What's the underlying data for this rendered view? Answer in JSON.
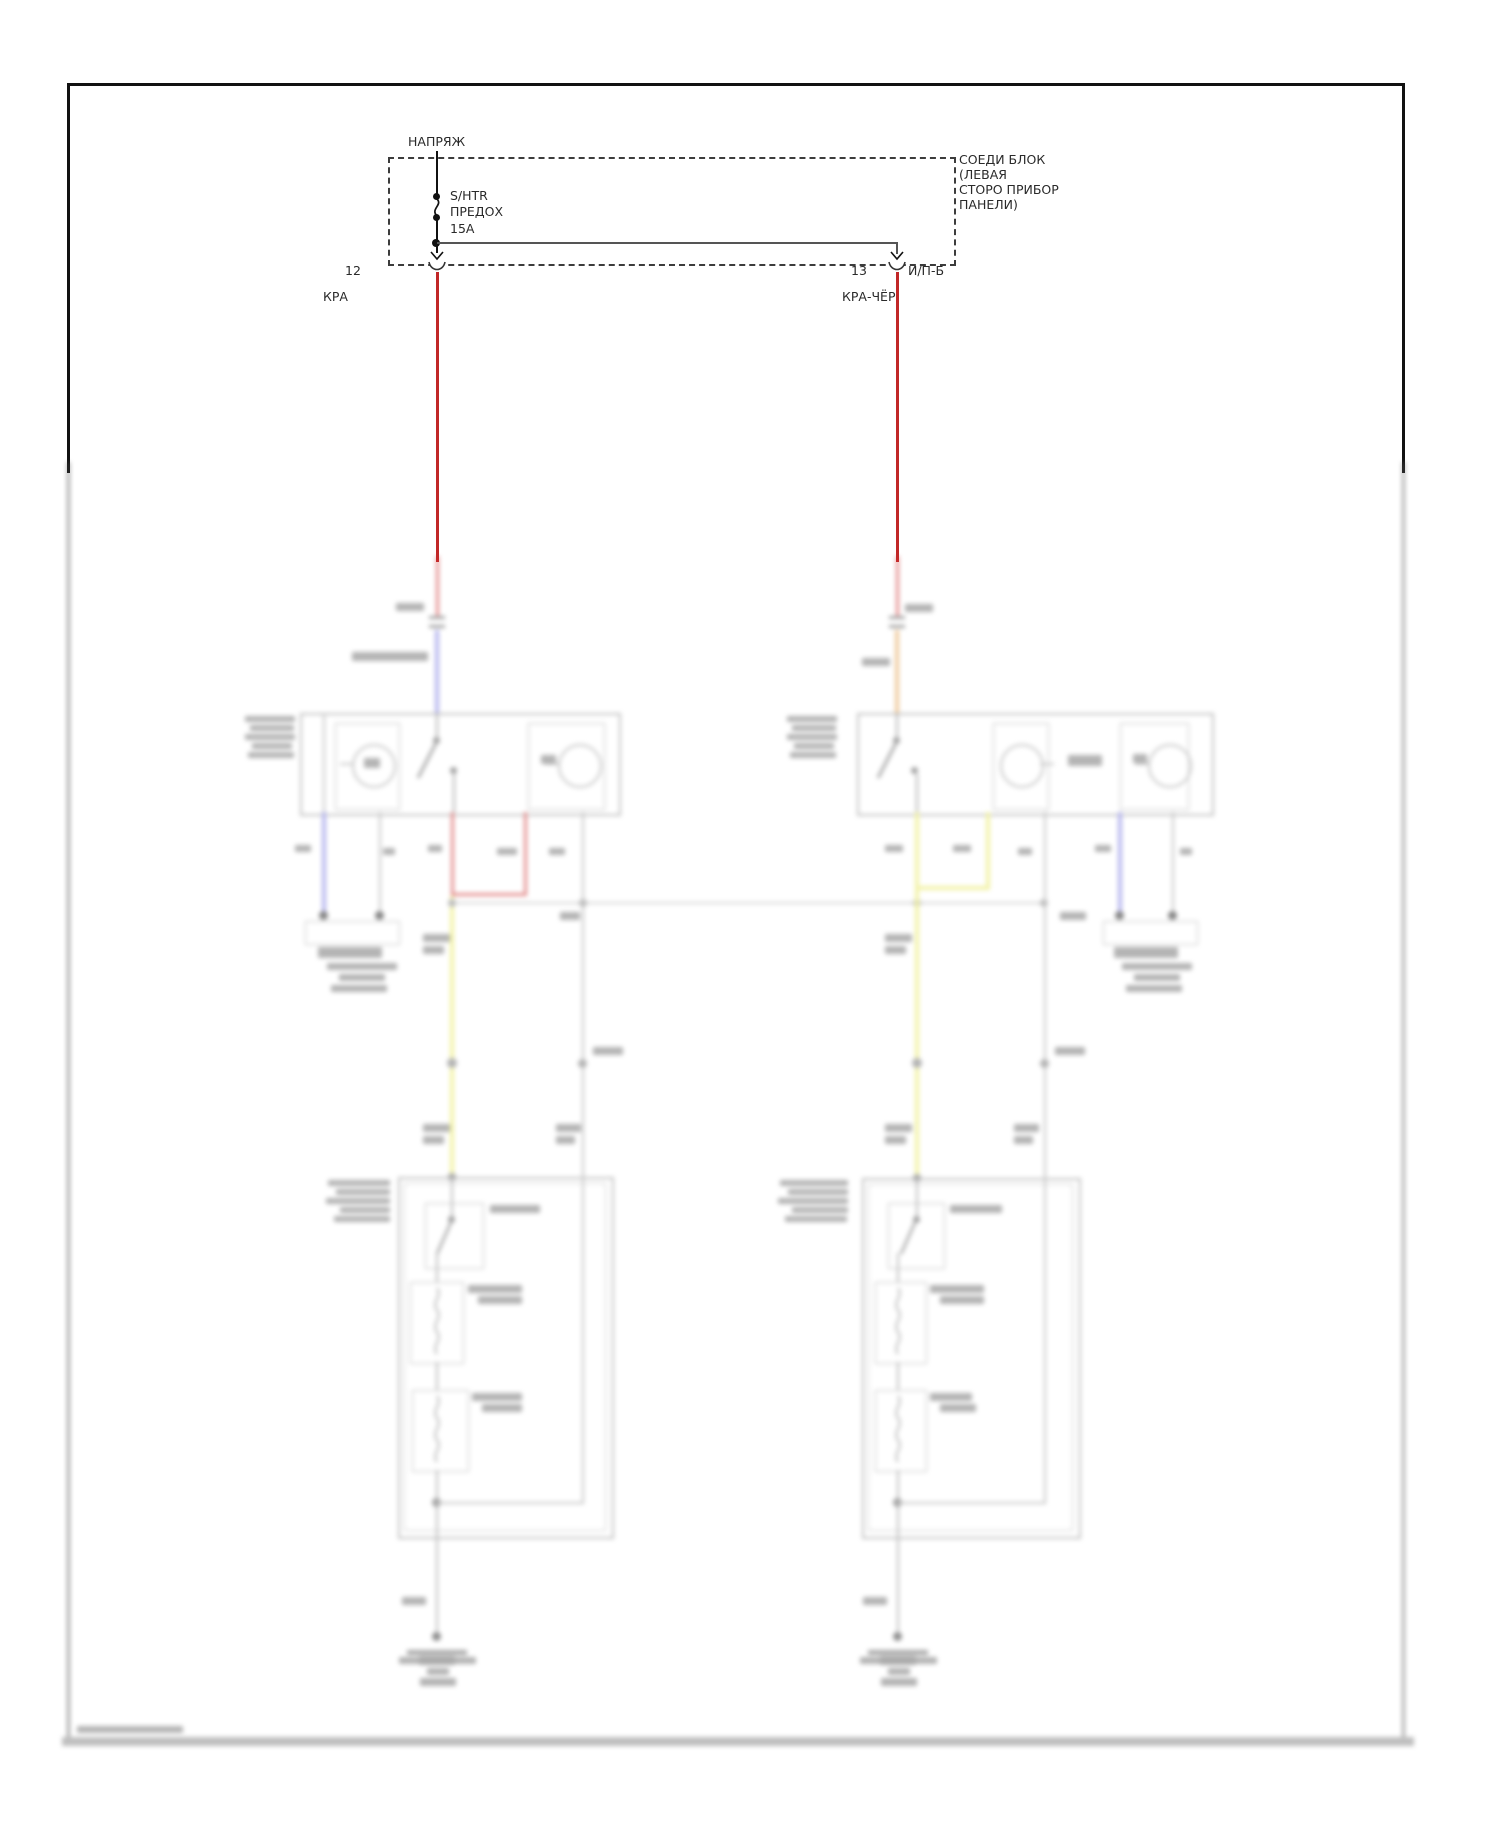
{
  "power_feed": {
    "label": "НАПРЯЖ",
    "fuse_lines": [
      "S/HTR",
      "ПРЕДОХ",
      "15A"
    ]
  },
  "junction_block": {
    "label_lines": [
      "СОЕДИ БЛОК",
      "(ЛЕВАЯ",
      "СТОРО ПРИБОР",
      "ПАНЕЛИ)"
    ]
  },
  "connectors": {
    "left_pin": "12",
    "left_wire": "КРА",
    "right_pin": "13",
    "right_pin_name": "И/П-Б",
    "right_wire": "КРА-ЧЁР"
  },
  "colors": {
    "wire_red": "#c12727",
    "wire_blue": "#7d7de0",
    "wire_orange": "#e2a050",
    "wire_yellow": "#ecec6a",
    "wire_gray": "#999999",
    "diagram_border": "#111111"
  }
}
